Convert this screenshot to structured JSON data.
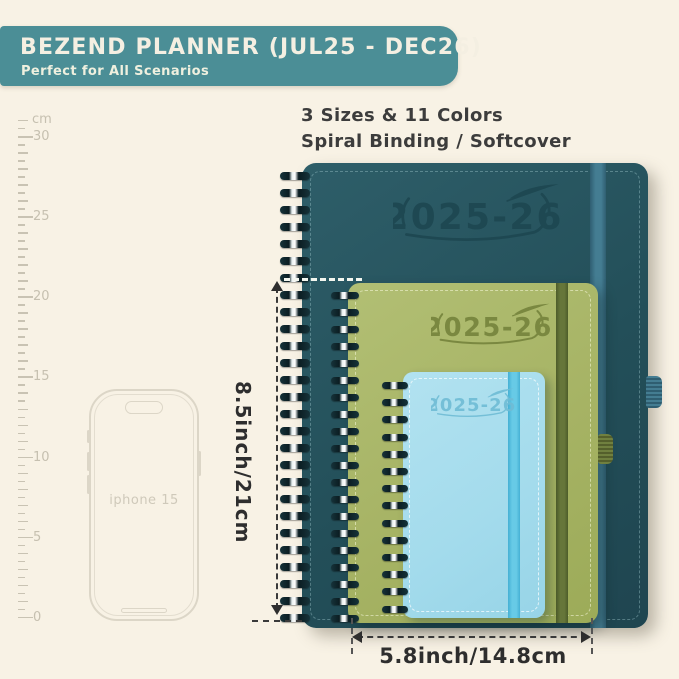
{
  "header": {
    "title": "BEZEND PLANNER (JUL25 - DEC26)",
    "subtitle": "Perfect for All Scenarios",
    "banner_color": "#4b8e96",
    "text_color": "#f4efe2"
  },
  "features": {
    "line1": "3 Sizes & 11 Colors",
    "line2": "Spiral Binding / Softcover"
  },
  "ruler": {
    "unit_label": "cm",
    "major_labels": [
      "30",
      "25",
      "20",
      "15",
      "10",
      "5",
      "0"
    ],
    "max_cm": 30
  },
  "phone": {
    "label": "iphone 15"
  },
  "planners": {
    "large": {
      "year_label": "2025-26",
      "cover_color": "#234f59",
      "band_color": "#447d92"
    },
    "medium": {
      "year_label": "2025-26",
      "cover_color": "#a5b263",
      "band_color": "#66763a"
    },
    "small": {
      "year_label": "2025-26",
      "cover_color": "#a3dbec",
      "band_color": "#67cae6"
    }
  },
  "dimensions": {
    "height_label": "8.5inch/21cm",
    "width_label": "5.8inch/14.8cm"
  }
}
